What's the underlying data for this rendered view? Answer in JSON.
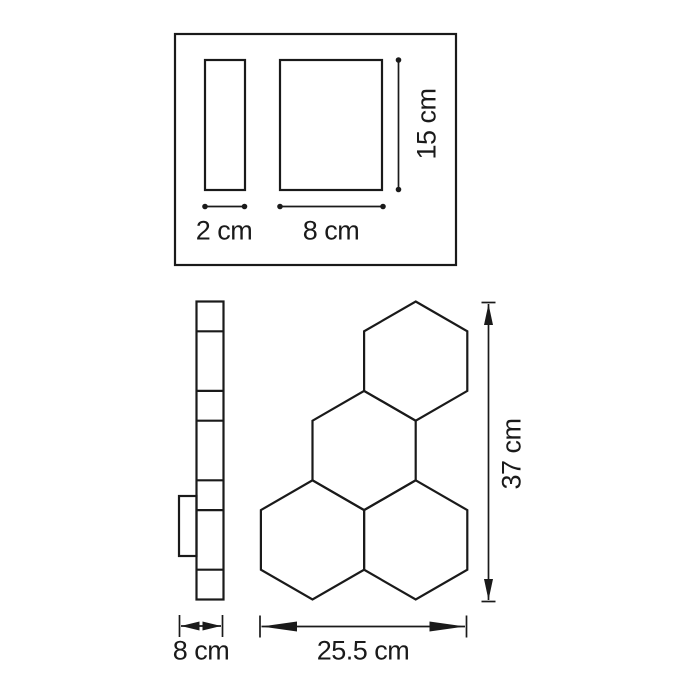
{
  "colors": {
    "background": "#ffffff",
    "line": "#1a1a1a",
    "text": "#1a1a1a"
  },
  "top_view": {
    "side_width_label": "2 cm",
    "front_width_label": "8 cm",
    "front_height_label": "15 cm"
  },
  "bottom_view": {
    "side_width_label": "8 cm",
    "front_width_label": "25.5 cm",
    "front_height_label": "37 cm"
  }
}
